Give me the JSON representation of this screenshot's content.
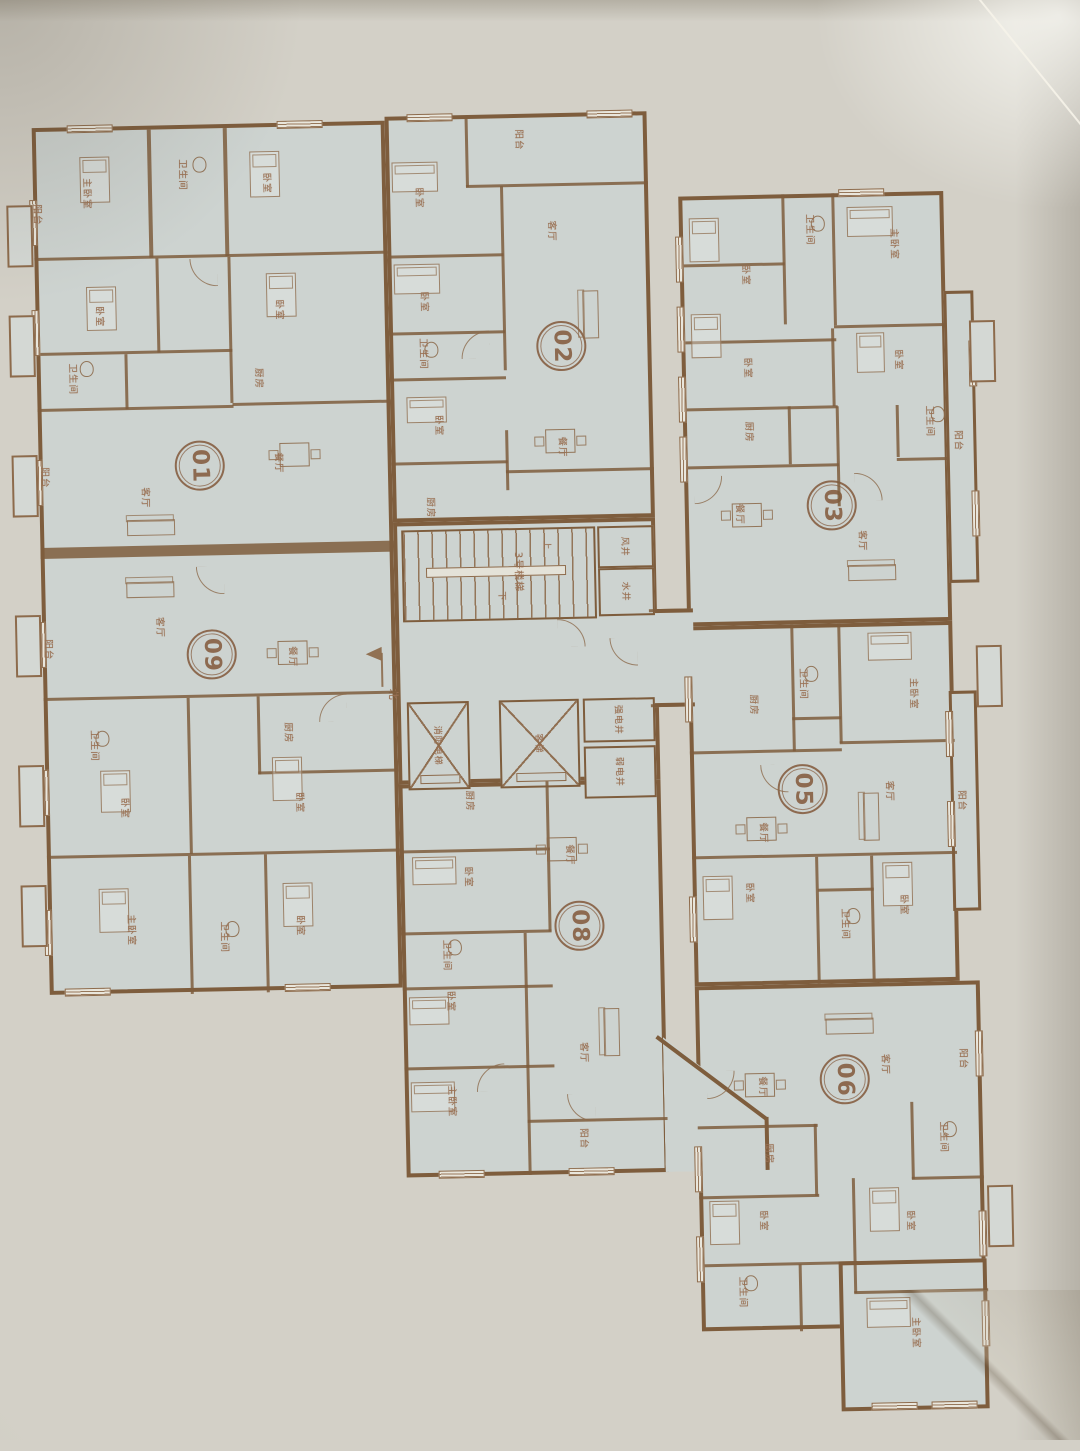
{
  "plan_title": "residential-floor-plan-photo",
  "colors": {
    "paper": "#d3d0c7",
    "floor": "#cdd3d0",
    "wall": "#7e5d3d",
    "line": "#8d6b4c",
    "label": "#9a7154",
    "badge": "#8d6a50"
  },
  "units": [
    {
      "id": "01",
      "rooms": [
        {
          "label": "主卧室"
        },
        {
          "label": "卫生间"
        },
        {
          "label": "卧室"
        },
        {
          "label": "阳台"
        },
        {
          "label": "卧室"
        },
        {
          "label": "卧室"
        },
        {
          "label": "卫生间"
        },
        {
          "label": "厨房"
        },
        {
          "label": "阳台"
        },
        {
          "label": "客厅"
        },
        {
          "label": "餐厅"
        }
      ]
    },
    {
      "id": "02",
      "rooms": [
        {
          "label": "阳台"
        },
        {
          "label": "卧室"
        },
        {
          "label": "客厅"
        },
        {
          "label": "卧室"
        },
        {
          "label": "卫生间"
        },
        {
          "label": "卧室"
        },
        {
          "label": "餐厅"
        },
        {
          "label": "厨房"
        }
      ]
    },
    {
      "id": "03",
      "rooms": [
        {
          "label": "卫生间"
        },
        {
          "label": "主卧室"
        },
        {
          "label": "卧室"
        },
        {
          "label": "卧室"
        },
        {
          "label": "卧室"
        },
        {
          "label": "厨房"
        },
        {
          "label": "卫生间"
        },
        {
          "label": "餐厅"
        },
        {
          "label": "客厅"
        },
        {
          "label": "阳台"
        }
      ]
    },
    {
      "id": "05",
      "rooms": [
        {
          "label": "厨房"
        },
        {
          "label": "卫生间"
        },
        {
          "label": "主卧室"
        },
        {
          "label": "餐厅"
        },
        {
          "label": "客厅"
        },
        {
          "label": "阳台"
        },
        {
          "label": "卧室"
        },
        {
          "label": "卫生间"
        },
        {
          "label": "卧室"
        }
      ]
    },
    {
      "id": "06",
      "rooms": [
        {
          "label": "餐厅"
        },
        {
          "label": "客厅"
        },
        {
          "label": "阳台"
        },
        {
          "label": "厨房"
        },
        {
          "label": "卫生间"
        },
        {
          "label": "卧室"
        },
        {
          "label": "卧室"
        },
        {
          "label": "卫生间"
        },
        {
          "label": "主卧室"
        }
      ]
    },
    {
      "id": "08",
      "rooms": [
        {
          "label": "厨房"
        },
        {
          "label": "餐厅"
        },
        {
          "label": "卧室"
        },
        {
          "label": "卫生间"
        },
        {
          "label": "卧室"
        },
        {
          "label": "主卧室"
        },
        {
          "label": "客厅"
        },
        {
          "label": "阳台"
        }
      ]
    },
    {
      "id": "09",
      "rooms": [
        {
          "label": "客厅"
        },
        {
          "label": "餐厅"
        },
        {
          "label": "阳台"
        },
        {
          "label": "卫生间"
        },
        {
          "label": "厨房"
        },
        {
          "label": "卧室"
        },
        {
          "label": "卧室"
        },
        {
          "label": "主卧室"
        },
        {
          "label": "卫生间"
        },
        {
          "label": "卧室"
        }
      ]
    }
  ],
  "core": {
    "stair": "3号楼梯",
    "up": "上",
    "down": "下",
    "fire_elevator": "消防电梯",
    "passenger_elevator": "客梯",
    "strong_shaft": "强电井",
    "weak_shaft": "弱电井",
    "air_shaft": "风井",
    "water_shaft": "水井",
    "north": "北"
  }
}
